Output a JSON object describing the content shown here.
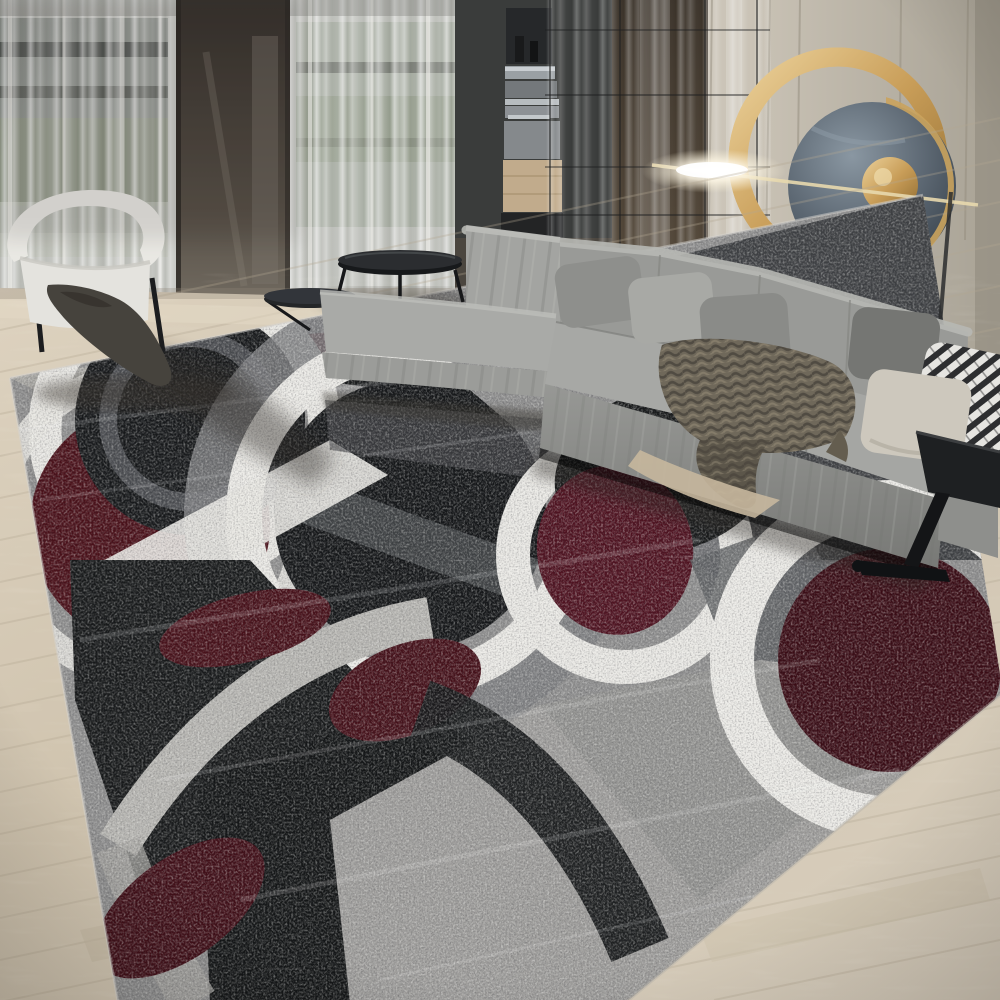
{
  "image": {
    "title": "Modern living room lifestyle photo: geometric circles area rug in black, gray, white and dark red, gray L-shaped sectional sofa, gold ring wall art, sheer curtains, light wood floor",
    "width_px": 1000,
    "height_px": 1000
  },
  "scene": {
    "room": "living-room",
    "objects": [
      {
        "name": "area-rug",
        "description": "large distressed rug with overlapping circle pattern in black, charcoal, gray, white and dark red"
      },
      {
        "name": "sectional-sofa",
        "description": "gray L-shaped sectional with chaise, gray and cream pillows, striped pillow and textured throw blanket"
      },
      {
        "name": "gold-ring-wall-art",
        "description": "round gold ring sculpture with dark marble disc, small gold disc and glowing light bar"
      },
      {
        "name": "sheer-curtains",
        "description": "floor to ceiling sheer curtains over windows"
      },
      {
        "name": "dark-mirror-panel",
        "description": "tall dark panel between curtain sections"
      },
      {
        "name": "built-in-cabinet",
        "description": "dark built-in cabinet with appliances and wood drawer"
      },
      {
        "name": "glass-partition",
        "description": "thin framed glass wall with reflections over dark wood panel"
      },
      {
        "name": "accent-wall",
        "description": "beige paneled wall with vertical grooves"
      },
      {
        "name": "accent-chair",
        "description": "white barrel chair with dark draped throw"
      },
      {
        "name": "nesting-coffee-tables",
        "description": "black oval nesting tables"
      },
      {
        "name": "side-table",
        "description": "black angular C-shaped side table"
      },
      {
        "name": "wood-floor",
        "description": "light oak plank floor laid diagonally"
      }
    ]
  },
  "colors": {
    "wall_beige": "#c8c1b4",
    "curtain": "#c6c7c2",
    "cabinet": "#3a3c3b",
    "panel_wood": "#463d31",
    "gold": "#c99f58",
    "marble": "#4e5a66",
    "sofa_gray": "#a2a3a0",
    "pillow_cream": "#cdc8bd",
    "pillow_stripe_dark": "#2d2e30",
    "blanket": "#6f685a",
    "chair_white": "#e9e8e3",
    "table_black": "#1e2022",
    "floor_wood": "#d5cab7",
    "rug_base": "#8e8e8e",
    "rug_gray": "#737477",
    "rug_gray_light": "#b5b4b0",
    "rug_white": "#eae9e5",
    "rug_charcoal": "#3e4043",
    "rug_black": "#141618",
    "rug_red": "#4a1019",
    "rug_maroon": "#3a0c15"
  }
}
